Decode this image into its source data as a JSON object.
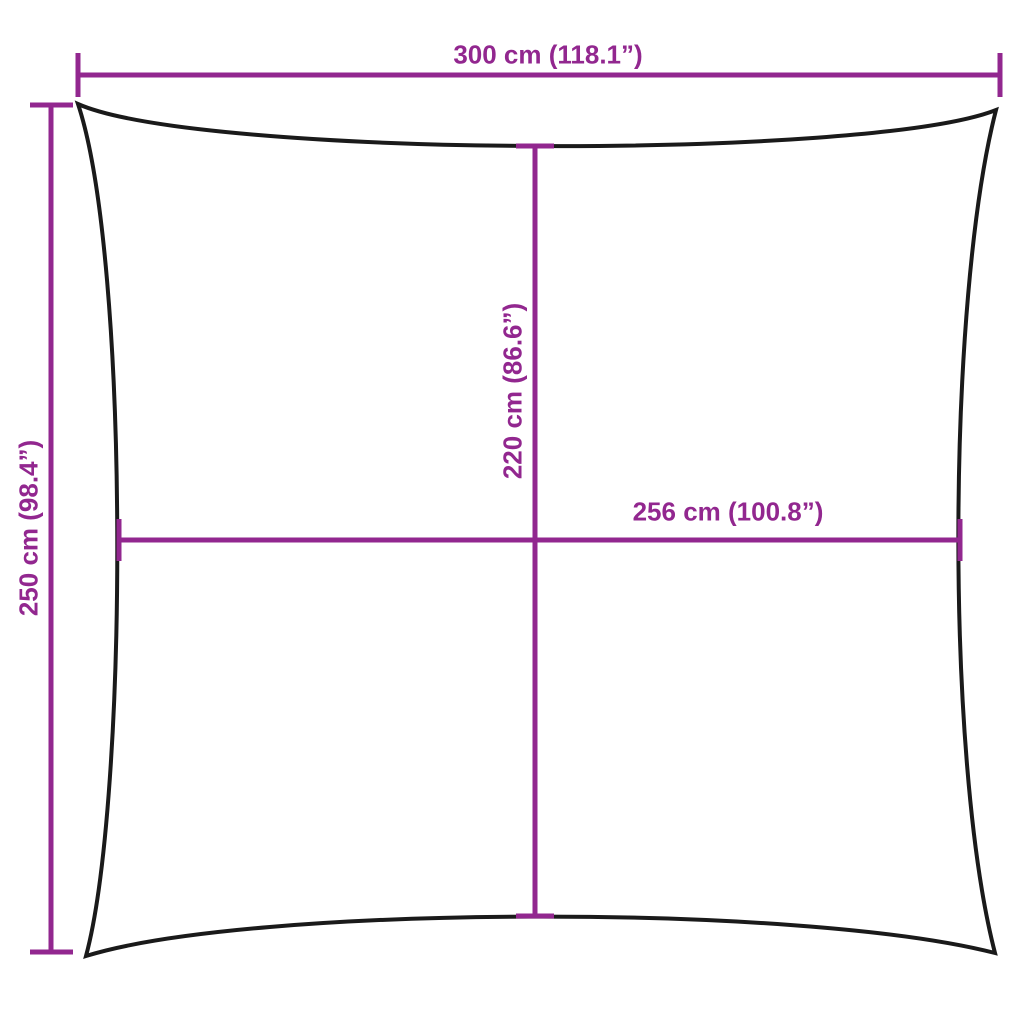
{
  "diagram": {
    "kind": "product-dimension-diagram",
    "subject": "square shade sail outline with concave edges",
    "colors": {
      "dimension_lines": "#92278F",
      "outline": "#1A1A1A",
      "background": "#FFFFFF"
    },
    "dimensions": {
      "top_width": {
        "label": "300 cm (118.1”)",
        "cm": 300,
        "inches": 118.1
      },
      "left_height": {
        "label": "250 cm (98.4”)",
        "cm": 250,
        "inches": 98.4
      },
      "center_height": {
        "label": "220 cm (86.6”)",
        "cm": 220,
        "inches": 86.6
      },
      "center_width": {
        "label": "256 cm (100.8”)",
        "cm": 256,
        "inches": 100.8
      }
    }
  }
}
